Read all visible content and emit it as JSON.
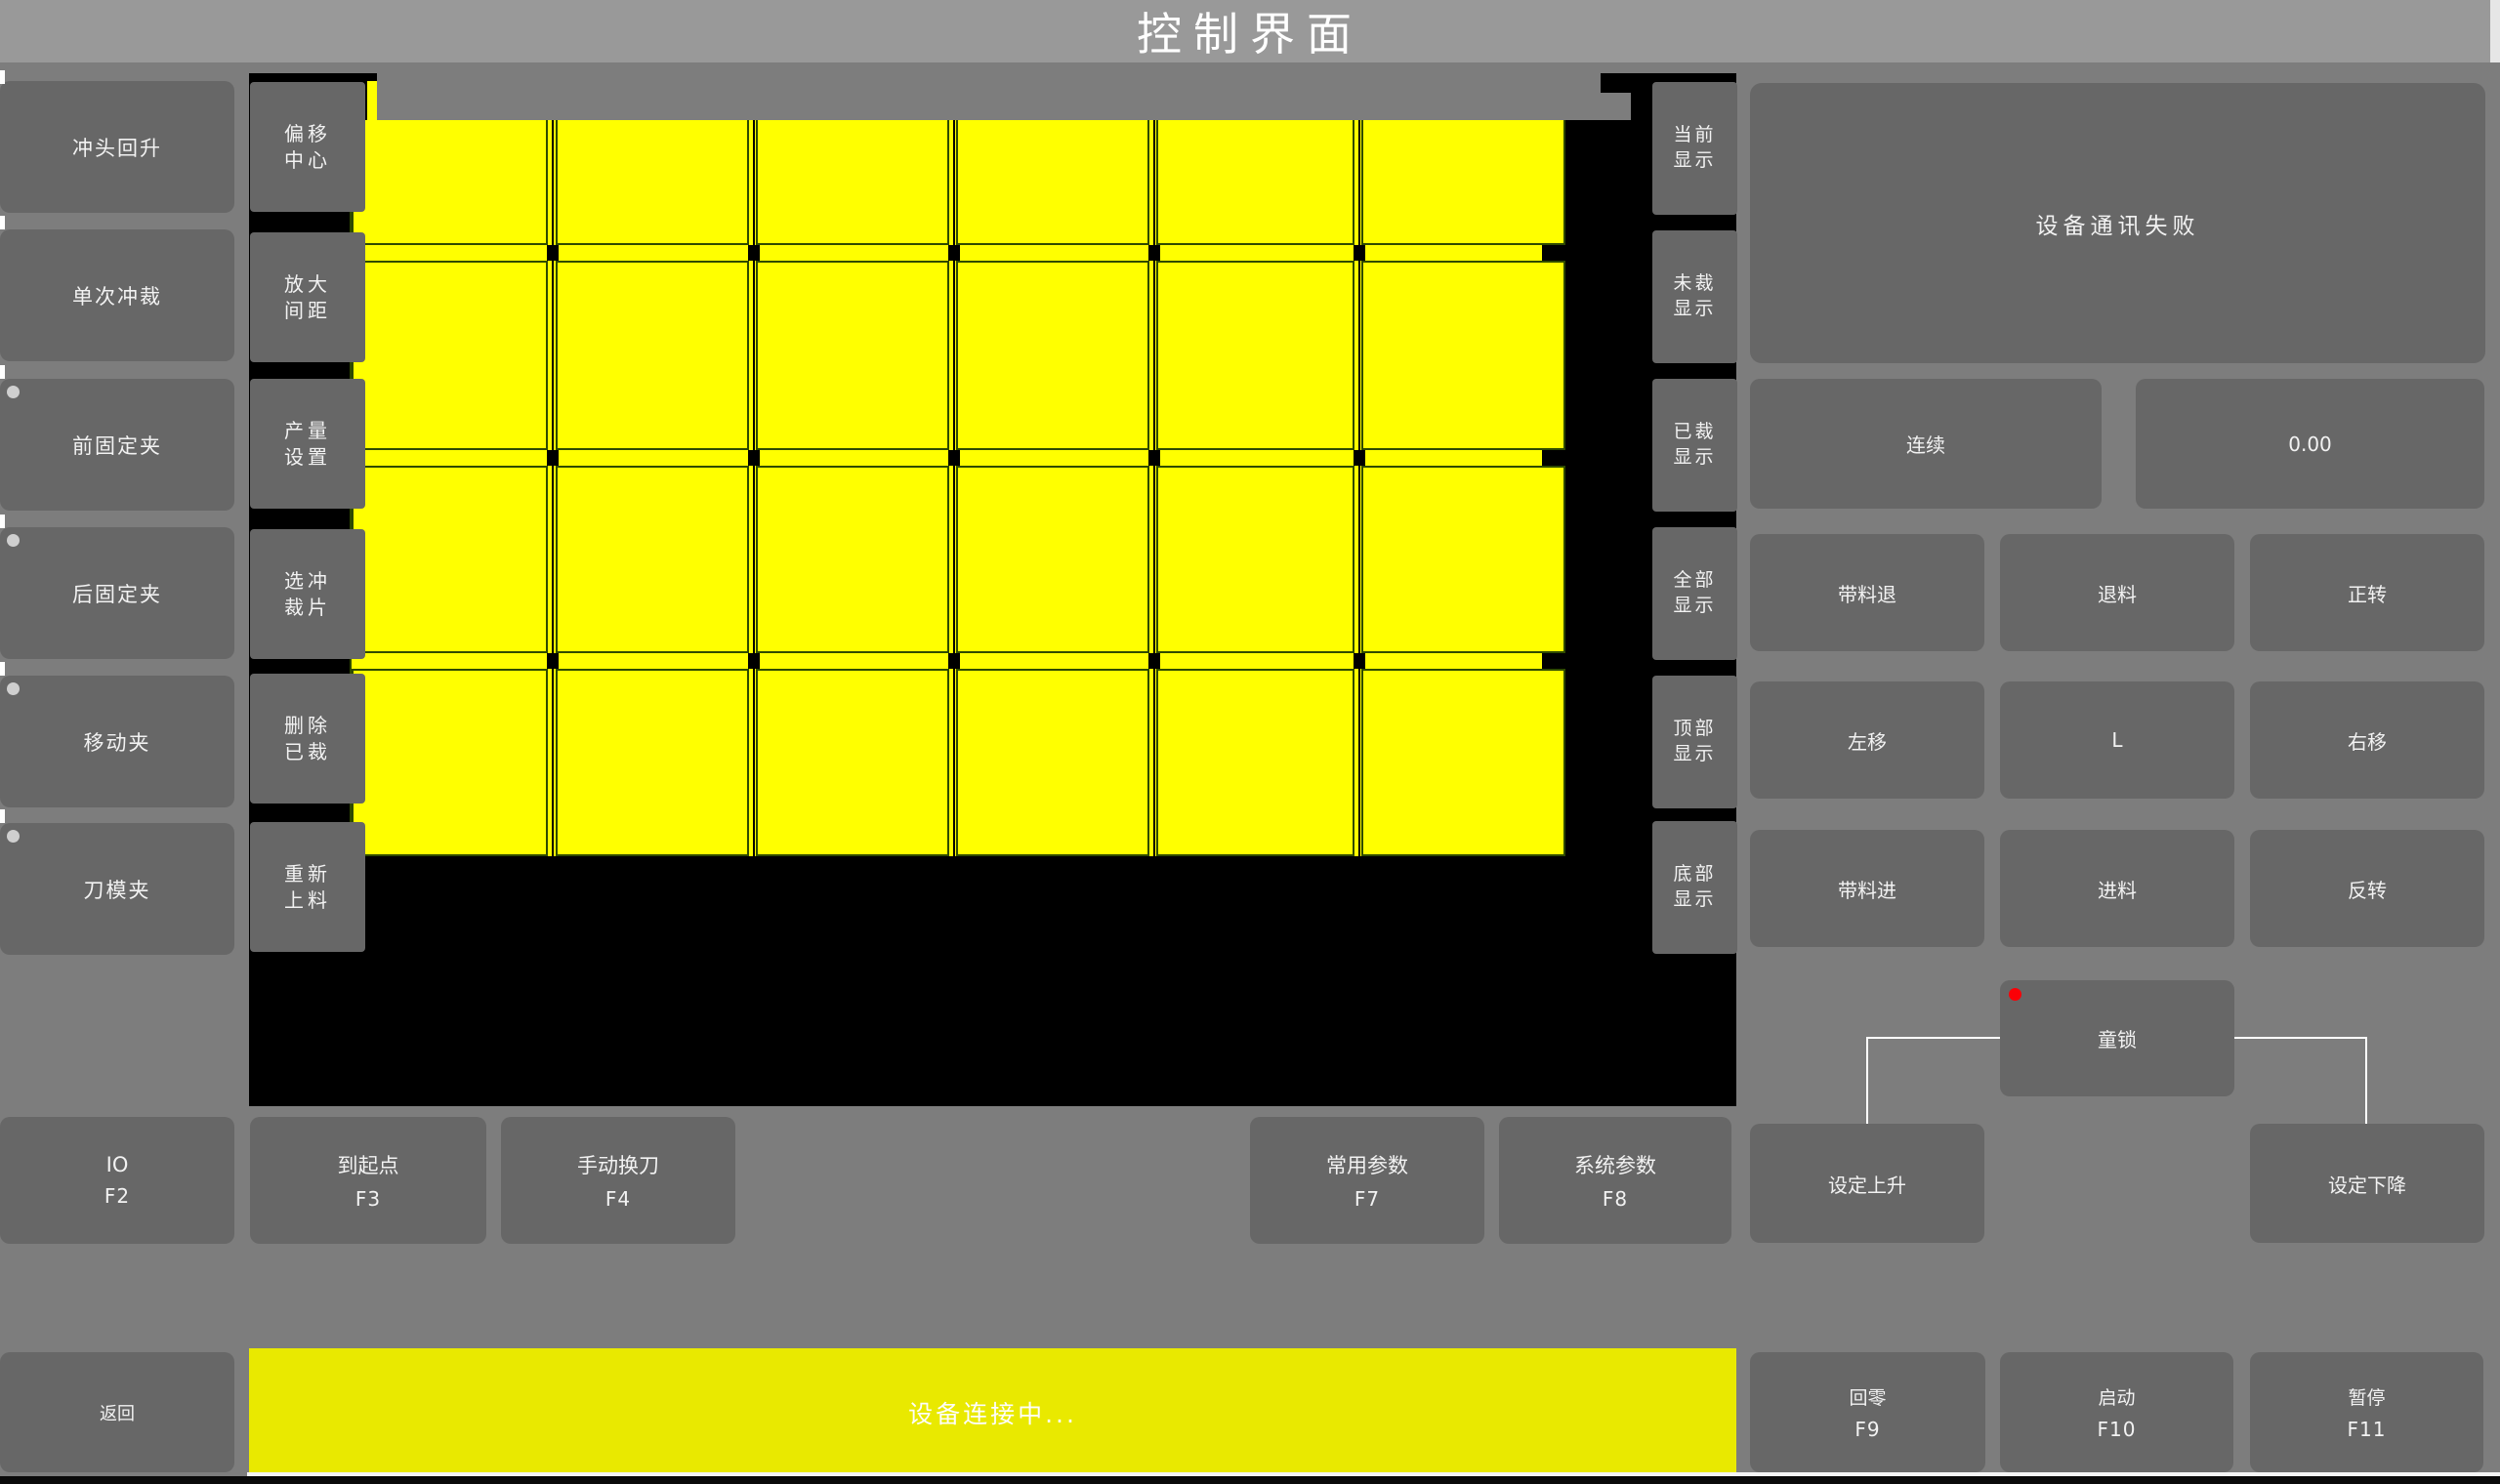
{
  "title": "控制界面",
  "colors": {
    "titlebar": "#999999",
    "body": "#7d7d7d",
    "button": "#676767",
    "canvas": "#000000",
    "sheet_yellow": "#ffff00",
    "cell_border": "#2f4a00",
    "status_yellow": "#e9e900",
    "indicator_gray": "#cfcfcf",
    "indicator_red": "#fb0006",
    "text": "#f2f2f2"
  },
  "left_sidebar": {
    "items": [
      {
        "label": "冲头回升",
        "indicator": false
      },
      {
        "label": "单次冲裁",
        "indicator": false
      },
      {
        "label": "前固定夹",
        "indicator": true
      },
      {
        "label": "后固定夹",
        "indicator": true
      },
      {
        "label": "移动夹",
        "indicator": true
      },
      {
        "label": "刀模夹",
        "indicator": true
      }
    ]
  },
  "tool_column": {
    "items": [
      {
        "line1": "偏移",
        "line2": "中心"
      },
      {
        "line1": "放大",
        "line2": "间距"
      },
      {
        "line1": "产量",
        "line2": "设置"
      },
      {
        "line1": "选冲",
        "line2": "裁片"
      },
      {
        "line1": "删除",
        "line2": "已裁"
      },
      {
        "line1": "重新",
        "line2": "上料"
      }
    ]
  },
  "display_column": {
    "items": [
      {
        "line1": "当前",
        "line2": "显示"
      },
      {
        "line1": "未裁",
        "line2": "显示"
      },
      {
        "line1": "已裁",
        "line2": "显示"
      },
      {
        "line1": "全部",
        "line2": "显示"
      },
      {
        "line1": "顶部",
        "line2": "显示"
      },
      {
        "line1": "底部",
        "line2": "显示"
      }
    ]
  },
  "sheet_grid": {
    "rows": 4,
    "cols": 6
  },
  "status_panel": {
    "message": "设备通讯失败"
  },
  "mode_row": {
    "continuous_label": "连续",
    "value": "0.00"
  },
  "jog_grid": {
    "labels": [
      "带料退",
      "退料",
      "正转",
      "左移",
      "L",
      "右移",
      "带料进",
      "进料",
      "反转"
    ]
  },
  "child_lock": {
    "label": "童锁"
  },
  "set_buttons": {
    "up": "设定上升",
    "down": "设定下降"
  },
  "function_row": [
    {
      "label": "IO",
      "key": "F2"
    },
    {
      "label": "到起点",
      "key": "F3"
    },
    {
      "label": "手动换刀",
      "key": "F4"
    },
    {
      "label": "常用参数",
      "key": "F7"
    },
    {
      "label": "系统参数",
      "key": "F8"
    }
  ],
  "bottom_bar": {
    "back_label": "返回",
    "status_text": "设备连接中...",
    "buttons": [
      {
        "label": "回零",
        "key": "F9"
      },
      {
        "label": "启动",
        "key": "F10"
      },
      {
        "label": "暂停",
        "key": "F11"
      }
    ]
  }
}
